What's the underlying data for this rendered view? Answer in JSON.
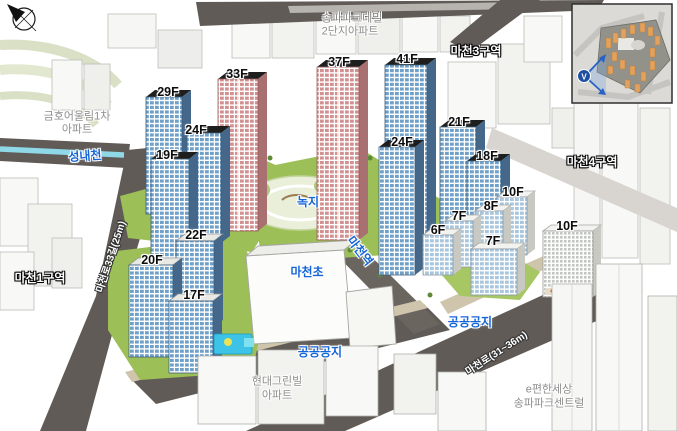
{
  "colors": {
    "road": "#615b57",
    "light_road": "#d8d5d1",
    "stream": "#8fd8e8",
    "grass": "#9cbf57",
    "park_fill": "#e9efd8",
    "sidewalk": "#cfc5ad",
    "window_blue": "#6fa0c9",
    "window_pink": "#d29090",
    "tower_cap": "#1e1e1e",
    "label_blue": "#1565d8",
    "inset_building_orange": "#e2a15c",
    "view_marker_blue": "#1f4fa0"
  },
  "floor_labels": [
    {
      "text": "29F",
      "x": 168,
      "y": 92
    },
    {
      "text": "33F",
      "x": 237,
      "y": 74
    },
    {
      "text": "37F",
      "x": 339,
      "y": 62
    },
    {
      "text": "41F",
      "x": 407,
      "y": 59
    },
    {
      "text": "24F",
      "x": 196,
      "y": 130
    },
    {
      "text": "19F",
      "x": 167,
      "y": 155
    },
    {
      "text": "24F",
      "x": 402,
      "y": 142
    },
    {
      "text": "21F",
      "x": 459,
      "y": 122
    },
    {
      "text": "18F",
      "x": 487,
      "y": 156
    },
    {
      "text": "10F",
      "x": 513,
      "y": 192
    },
    {
      "text": "8F",
      "x": 491,
      "y": 206
    },
    {
      "text": "7F",
      "x": 459,
      "y": 216
    },
    {
      "text": "6F",
      "x": 438,
      "y": 230
    },
    {
      "text": "7F",
      "x": 493,
      "y": 241
    },
    {
      "text": "10F",
      "x": 567,
      "y": 226
    },
    {
      "text": "22F",
      "x": 196,
      "y": 235
    },
    {
      "text": "20F",
      "x": 152,
      "y": 260
    },
    {
      "text": "17F",
      "x": 194,
      "y": 295
    }
  ],
  "place_labels": [
    {
      "text": "성내천",
      "x": 85,
      "y": 156,
      "rotate": -4
    },
    {
      "text": "녹지",
      "x": 308,
      "y": 202
    },
    {
      "text": "마천역",
      "x": 360,
      "y": 251,
      "rotate": 52
    },
    {
      "text": "마천초",
      "x": 307,
      "y": 272
    },
    {
      "text": "공공공지",
      "x": 320,
      "y": 352
    },
    {
      "text": "공공공지",
      "x": 470,
      "y": 322
    }
  ],
  "zone_labels": [
    {
      "text": "마천3구역",
      "x": 476,
      "y": 51
    },
    {
      "text": "마천4구역",
      "x": 592,
      "y": 162
    },
    {
      "text": "마천1구역",
      "x": 40,
      "y": 278
    }
  ],
  "road_labels": [
    {
      "text": "마천로(31~36m)",
      "x": 497,
      "y": 354,
      "rotate": -33
    },
    {
      "text": "마천로33길(25m)",
      "x": 112,
      "y": 257,
      "rotate": -72
    }
  ],
  "building_labels": [
    {
      "text": "송파파크데일",
      "x": 352,
      "y": 19
    },
    {
      "text": "2단지아파트",
      "x": 350,
      "y": 32
    },
    {
      "text": "금호어울림1차",
      "x": 77,
      "y": 117
    },
    {
      "text": "아파트",
      "x": 77,
      "y": 130
    },
    {
      "text": "현대그린빌",
      "x": 277,
      "y": 382
    },
    {
      "text": "아파트",
      "x": 277,
      "y": 396
    },
    {
      "text": "e편한세상",
      "x": 549,
      "y": 390
    },
    {
      "text": "송파파크센트럴",
      "x": 549,
      "y": 404
    }
  ],
  "inset": {
    "view_marker": "V"
  }
}
